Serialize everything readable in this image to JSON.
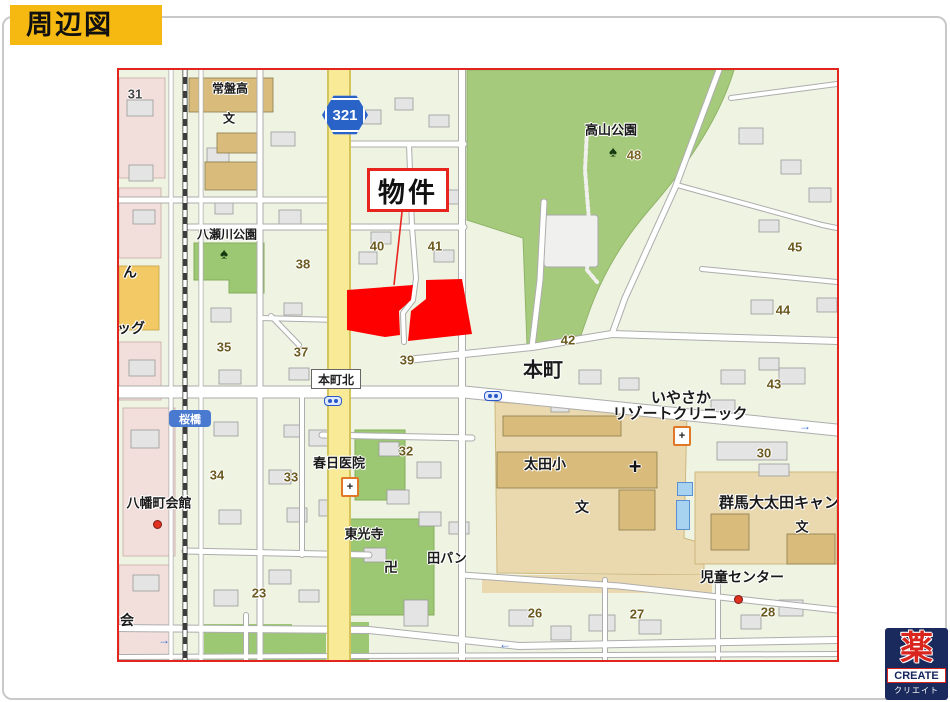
{
  "title_badge": "周辺図",
  "map": {
    "route_shield": "321",
    "property": "物件",
    "places": {
      "tokiwa_high": "常盤高",
      "takayama_park": "高山公園",
      "yasegawa_park": "八瀬川公園",
      "honcho_kita": "本町北",
      "honcho": "本町",
      "sakurabashi": "桜橋",
      "kasuga_clinic": "春日医院",
      "hachimancho_hall": "八幡町会館",
      "tokoji": "東光寺",
      "bakery": "田パン",
      "ota_elem": "太田小",
      "iyasaka1": "いやさか",
      "iyasaka2": "リゾートクリニック",
      "gunma_univ": "群馬大太田キャン",
      "jido_center": "児童センター",
      "edge_n": "ん",
      "edge_ggu": "ッグ",
      "edge_kai": "会",
      "manji": "卍",
      "school_mark": "文"
    },
    "numbers": {
      "n31": "31",
      "n48": "48",
      "n40": "40",
      "n41": "41",
      "n38": "38",
      "n35": "35",
      "n37": "37",
      "n39": "39",
      "n42": "42",
      "n43": "43",
      "n44": "44",
      "n45": "45",
      "n30": "30",
      "n32": "32",
      "n33": "33",
      "n34": "34",
      "n23": "23",
      "n26": "26",
      "n27": "27",
      "n28": "28"
    },
    "icons": {
      "tree": "♠",
      "plus": "+",
      "arrow_left": "←",
      "arrow_right": "→"
    },
    "colors": {
      "park": "#a6ca7c",
      "school_area": "#ead9ae",
      "school_bldg": "#d9bc7c",
      "yellow_road": "#f8ea96",
      "property_red": "#ff0000",
      "map_border": "#e3251f",
      "pink_block": "#f2dfdc",
      "badge_yellow": "#f5b912"
    }
  },
  "logo": {
    "kanji": "薬",
    "name": "CREATE",
    "sub": "クリエイト"
  }
}
